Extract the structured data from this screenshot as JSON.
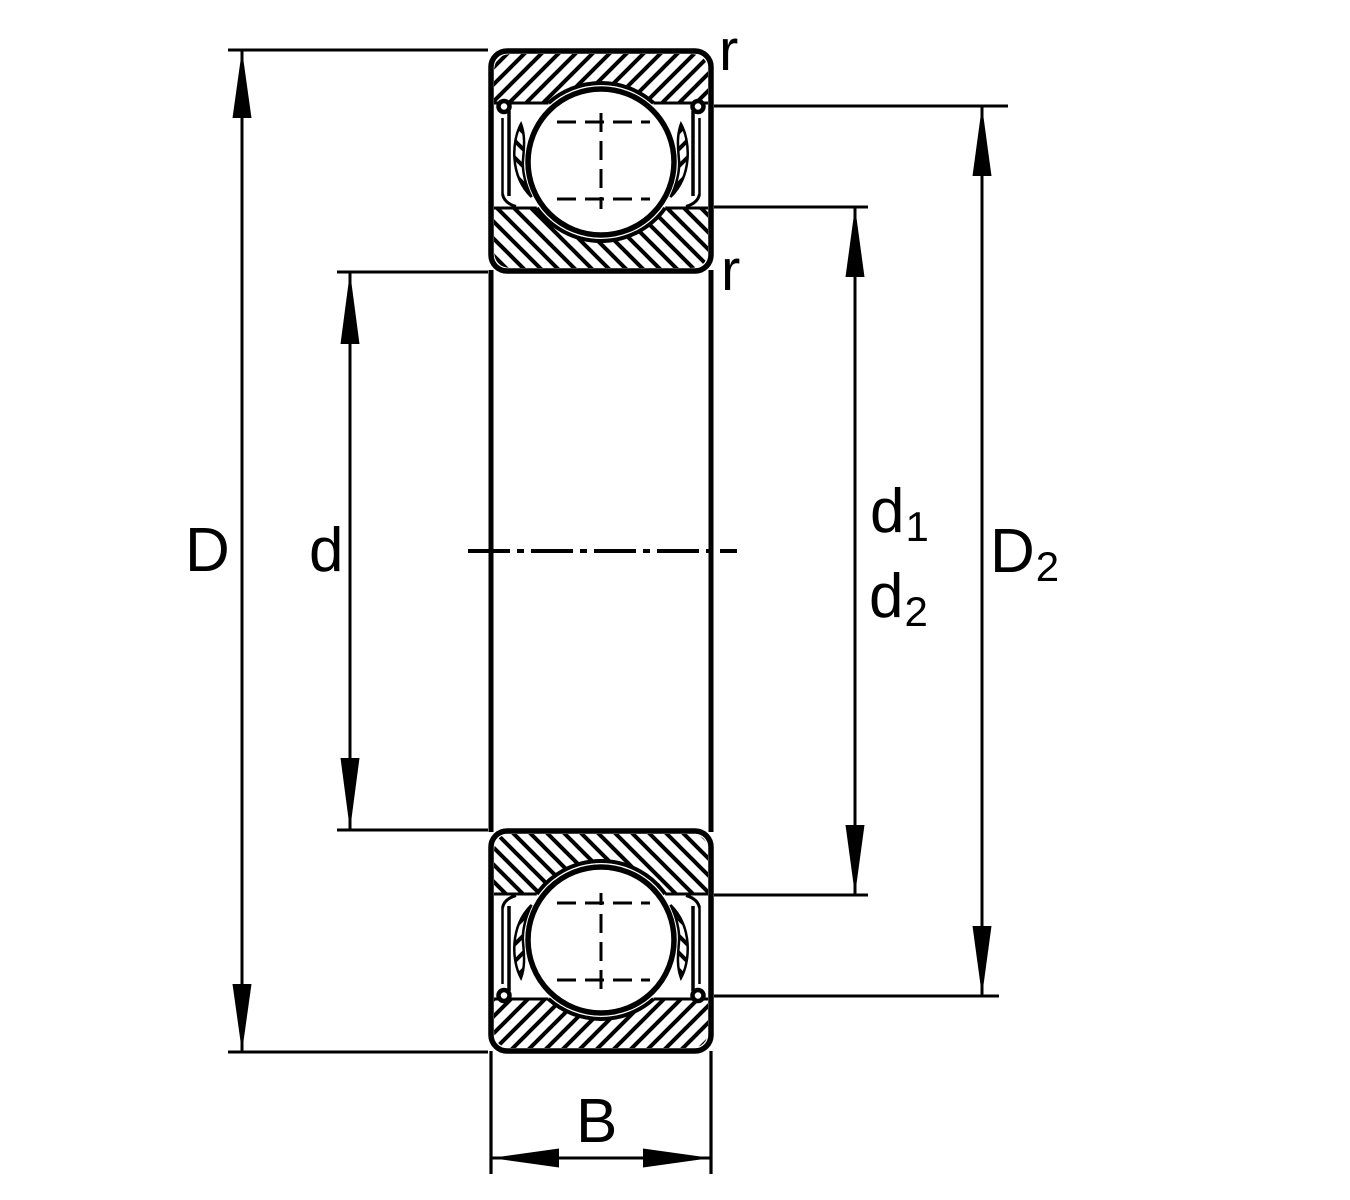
{
  "diagram": {
    "type": "deep-groove-ball-bearing-cross-section",
    "background_color": "#ffffff",
    "line_color": "#000000",
    "labels": {
      "D": {
        "base": "D",
        "sub": ""
      },
      "d": {
        "base": "d",
        "sub": ""
      },
      "d1": {
        "base": "d",
        "sub": "1"
      },
      "d2": {
        "base": "d",
        "sub": "2"
      },
      "D2": {
        "base": "D",
        "sub": "2"
      },
      "B": {
        "base": "B",
        "sub": ""
      },
      "r_top": {
        "base": "r",
        "sub": ""
      },
      "r_bottom": {
        "base": "r",
        "sub": ""
      }
    }
  }
}
